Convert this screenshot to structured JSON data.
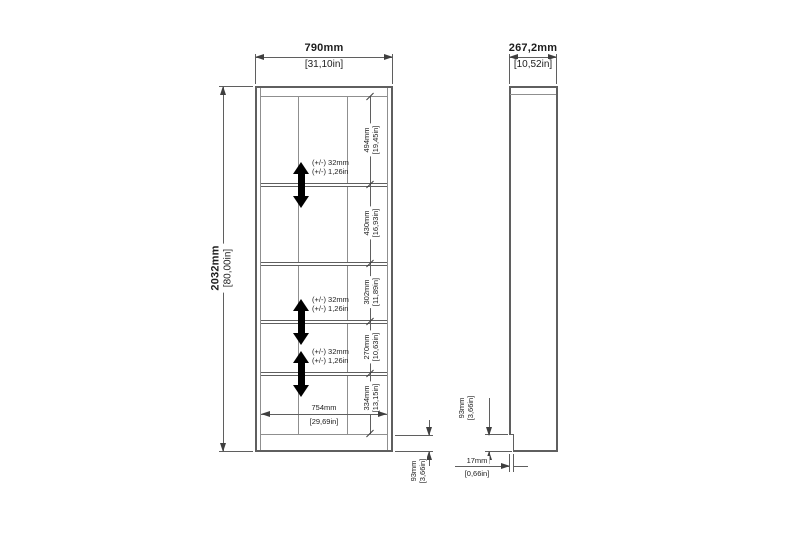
{
  "front_view": {
    "width_mm": "790mm",
    "width_in": "[31,10in]",
    "height_mm": "2032mm",
    "height_in": "[80,00in]",
    "inner_width_mm": "754mm",
    "inner_width_in": "[29,69in]",
    "plinth_mm": "93mm",
    "plinth_in": "[3,66in]",
    "compartments": [
      {
        "mm": "494mm",
        "in": "[19,45in]"
      },
      {
        "mm": "430mm",
        "in": "[16,93in]"
      },
      {
        "mm": "302mm",
        "in": "[11,89in]"
      },
      {
        "mm": "270mm",
        "in": "[10,63in]"
      },
      {
        "mm": "334mm",
        "in": "[13,15in]"
      }
    ],
    "shelf_adjust_mm": "(+/-) 32mm",
    "shelf_adjust_in": "(+/-) 1,26in"
  },
  "side_view": {
    "depth_mm": "267,2mm",
    "depth_in": "[10,52in]",
    "plinth_mm": "93mm",
    "plinth_in": "[3,66in]",
    "recess_mm": "17mm",
    "recess_in": "[0,66in]"
  },
  "colors": {
    "line": "#5f5f5f",
    "arrow": "#000000",
    "background": "#ffffff"
  }
}
